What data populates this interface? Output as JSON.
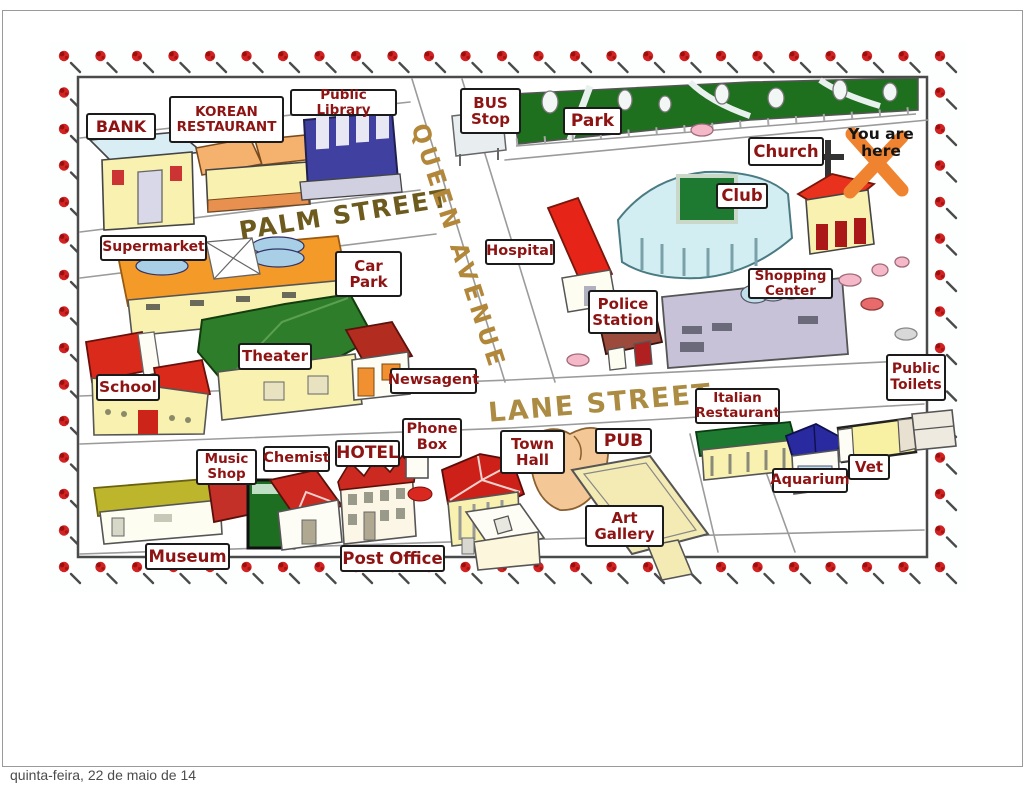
{
  "footer": {
    "date": "quinta-feira, 22 de maio de 14"
  },
  "map": {
    "marker": {
      "text": "You are\nhere",
      "x_color": "#ef8330"
    },
    "streets": [
      {
        "id": "palm-street",
        "name": "PALM STREET"
      },
      {
        "id": "queen-avenue",
        "name": "QUEEN AVENUE"
      },
      {
        "id": "lane-street",
        "name": "LANE STREET"
      }
    ],
    "labels": [
      {
        "id": "bank",
        "text": "BANK"
      },
      {
        "id": "korean-restaurant",
        "text": "KOREAN\nRESTAURANT"
      },
      {
        "id": "public-library",
        "text": "Public Library"
      },
      {
        "id": "bus-stop",
        "text": "BUS\nStop"
      },
      {
        "id": "park",
        "text": "Park"
      },
      {
        "id": "church",
        "text": "Church"
      },
      {
        "id": "club",
        "text": "Club"
      },
      {
        "id": "supermarket",
        "text": "Supermarket"
      },
      {
        "id": "car-park",
        "text": "Car\nPark"
      },
      {
        "id": "hospital",
        "text": "Hospital"
      },
      {
        "id": "police-station",
        "text": "Police\nStation"
      },
      {
        "id": "shopping-center",
        "text": "Shopping\nCenter"
      },
      {
        "id": "theater",
        "text": "Theater"
      },
      {
        "id": "school",
        "text": "School"
      },
      {
        "id": "newsagent",
        "text": "Newsagent"
      },
      {
        "id": "public-toilets",
        "text": "Public\nToilets"
      },
      {
        "id": "italian-restaurant",
        "text": "Italian\nRestaurant"
      },
      {
        "id": "phone-box",
        "text": "Phone\nBox"
      },
      {
        "id": "hotel",
        "text": "HOTEL"
      },
      {
        "id": "chemist",
        "text": "Chemist"
      },
      {
        "id": "music-shop",
        "text": "Music\nShop"
      },
      {
        "id": "town-hall",
        "text": "Town\nHall"
      },
      {
        "id": "pub",
        "text": "PUB"
      },
      {
        "id": "aquarium",
        "text": "Aquarium"
      },
      {
        "id": "vet",
        "text": "Vet"
      },
      {
        "id": "art-gallery",
        "text": "Art\nGallery"
      },
      {
        "id": "museum",
        "text": "Museum"
      },
      {
        "id": "post-office",
        "text": "Post Office"
      }
    ],
    "colors": {
      "label_text": "#8e1313",
      "street_text": "#a98a3e",
      "border_dot": "#d22222",
      "park_green": "#1e6f1e",
      "marker_x": "#ef8330"
    }
  }
}
